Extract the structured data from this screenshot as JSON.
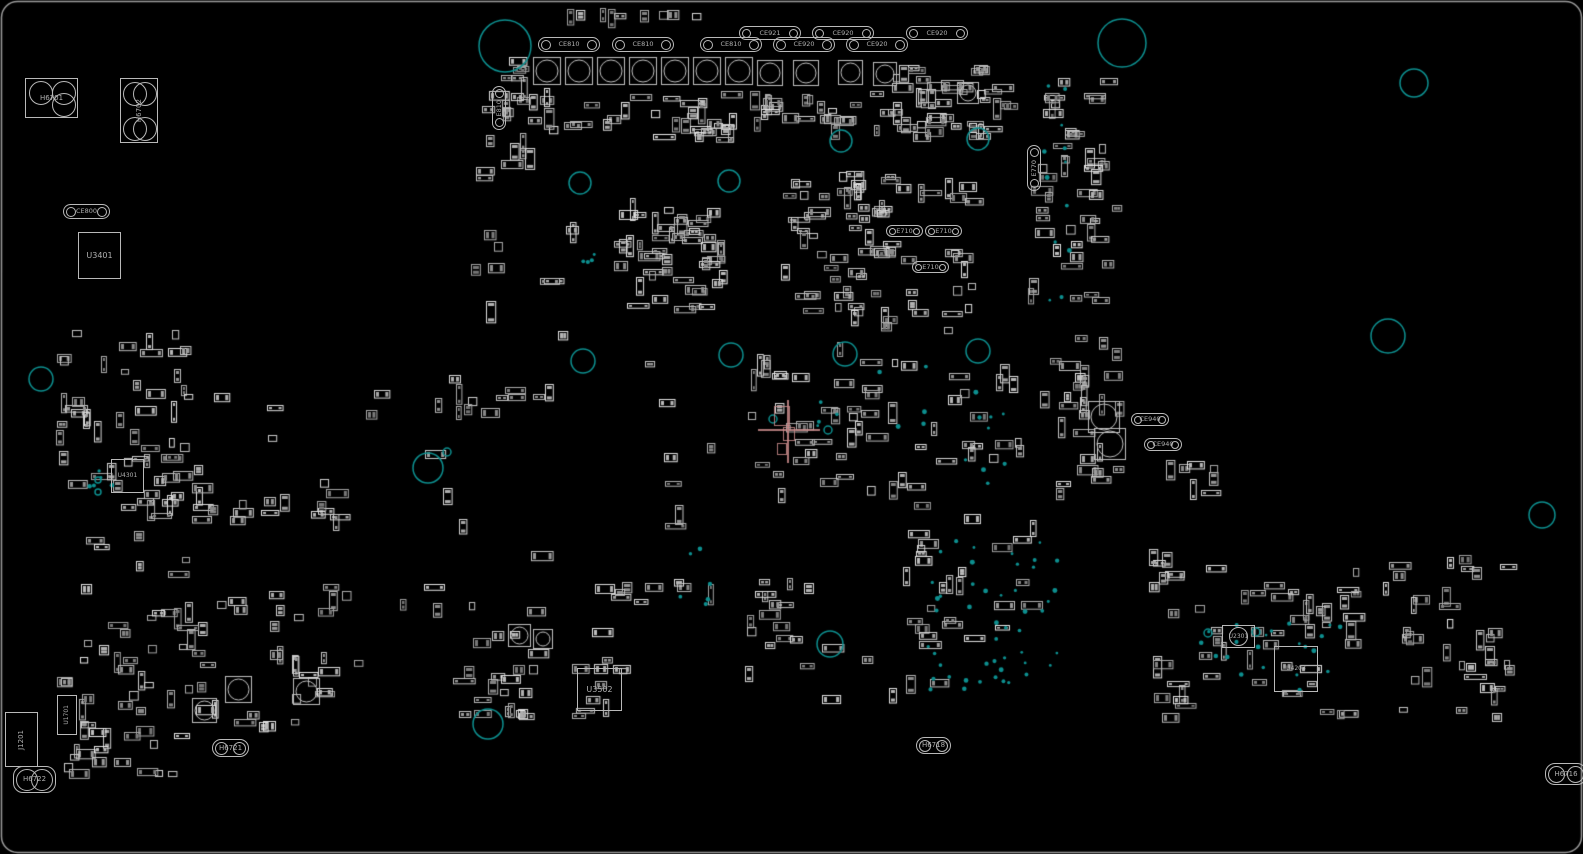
{
  "board": {
    "title": "pcb-component-placement-view",
    "colors": {
      "background": "#000000",
      "silkscreen": "#b4b4b4",
      "pad_fill": "#878787",
      "board_edge": "#9a9a9a",
      "teal": "#0d8f8f",
      "cursor": "#c98b8b"
    },
    "cursor": {
      "x": 788,
      "y": 430
    },
    "components": [
      {
        "type": "bracket",
        "label": "H6701",
        "x": 25,
        "y": 78,
        "w": 53,
        "h": 40,
        "circles": [
          {
            "dx": 3,
            "dy": 2,
            "d": 24
          },
          {
            "dx": 26,
            "dy": 2,
            "d": 24
          },
          {
            "dx": 26,
            "dy": 14,
            "d": 24
          }
        ]
      },
      {
        "type": "bracket",
        "label": "H6702",
        "x": 120,
        "y": 78,
        "w": 38,
        "h": 65,
        "vertical": true,
        "circles": [
          {
            "dx": 2,
            "dy": 3,
            "d": 24
          },
          {
            "dx": 12,
            "dy": 3,
            "d": 24
          },
          {
            "dx": 2,
            "dy": 38,
            "d": 24
          },
          {
            "dx": 12,
            "dy": 38,
            "d": 24
          }
        ]
      },
      {
        "type": "cap",
        "label": "CE800",
        "x": 63,
        "y": 204,
        "w": 47,
        "h": 15
      },
      {
        "type": "ic",
        "label": "U3401",
        "x": 78,
        "y": 232,
        "w": 43,
        "h": 47
      },
      {
        "type": "cap",
        "label": "CE810",
        "x": 538,
        "y": 37,
        "w": 62,
        "h": 15
      },
      {
        "type": "cap",
        "label": "CE810",
        "x": 612,
        "y": 37,
        "w": 62,
        "h": 15
      },
      {
        "type": "cap",
        "label": "CE810",
        "x": 700,
        "y": 37,
        "w": 62,
        "h": 15
      },
      {
        "type": "cap",
        "label": "CE920",
        "x": 773,
        "y": 37,
        "w": 62,
        "h": 15
      },
      {
        "type": "cap",
        "label": "CE920",
        "x": 846,
        "y": 37,
        "w": 62,
        "h": 15
      },
      {
        "type": "cap",
        "label": "CE921",
        "x": 739,
        "y": 26,
        "w": 62,
        "h": 14
      },
      {
        "type": "cap",
        "label": "CE920",
        "x": 812,
        "y": 26,
        "w": 62,
        "h": 14
      },
      {
        "type": "cap",
        "label": "CE920",
        "x": 906,
        "y": 26,
        "w": 62,
        "h": 14
      },
      {
        "type": "cap",
        "label": "E810",
        "x": 492,
        "y": 86,
        "w": 14,
        "h": 44,
        "vertical": true
      },
      {
        "type": "cap",
        "label": "E770",
        "x": 1027,
        "y": 145,
        "w": 14,
        "h": 46,
        "vertical": true
      },
      {
        "type": "cap",
        "label": "E710",
        "x": 886,
        "y": 225,
        "w": 37,
        "h": 12
      },
      {
        "type": "cap",
        "label": "E710",
        "x": 925,
        "y": 225,
        "w": 37,
        "h": 12
      },
      {
        "type": "cap",
        "label": "E710",
        "x": 912,
        "y": 261,
        "w": 37,
        "h": 12
      },
      {
        "type": "cap",
        "label": "CE940",
        "x": 1131,
        "y": 413,
        "w": 38,
        "h": 13
      },
      {
        "type": "cap",
        "label": "CE940",
        "x": 1144,
        "y": 438,
        "w": 38,
        "h": 13
      },
      {
        "type": "ic",
        "label": "U4301",
        "x": 111,
        "y": 459,
        "w": 33,
        "h": 34,
        "small": true
      },
      {
        "type": "ic",
        "label": "U3502",
        "x": 577,
        "y": 668,
        "w": 45,
        "h": 43
      },
      {
        "type": "roundcap",
        "label": "U2301",
        "x": 1222,
        "y": 625,
        "w": 33,
        "h": 23
      },
      {
        "type": "ic",
        "label": "U4203",
        "x": 1274,
        "y": 646,
        "w": 44,
        "h": 46,
        "small": true
      },
      {
        "type": "conn",
        "label": "J1201",
        "x": 5,
        "y": 712,
        "w": 33,
        "h": 55,
        "vertical": true
      },
      {
        "type": "ic",
        "label": "U1701",
        "x": 57,
        "y": 695,
        "w": 20,
        "h": 40,
        "vertical": true,
        "small": true
      },
      {
        "type": "hole",
        "label": "H6721",
        "x": 212,
        "y": 739,
        "w": 37,
        "h": 18
      },
      {
        "type": "hole",
        "label": "H6718",
        "x": 916,
        "y": 737,
        "w": 35,
        "h": 17
      },
      {
        "type": "hole",
        "label": "H6722",
        "x": 13,
        "y": 766,
        "w": 43,
        "h": 27
      },
      {
        "type": "hole",
        "label": "H6716",
        "x": 1545,
        "y": 763,
        "w": 42,
        "h": 22
      }
    ],
    "teal_circles": [
      {
        "x": 505,
        "y": 46,
        "r": 26
      },
      {
        "x": 1122,
        "y": 43,
        "r": 24
      },
      {
        "x": 1414,
        "y": 83,
        "r": 14
      },
      {
        "x": 841,
        "y": 141,
        "r": 11
      },
      {
        "x": 978,
        "y": 139,
        "r": 11
      },
      {
        "x": 580,
        "y": 183,
        "r": 11
      },
      {
        "x": 729,
        "y": 181,
        "r": 11
      },
      {
        "x": 583,
        "y": 361,
        "r": 12
      },
      {
        "x": 731,
        "y": 355,
        "r": 12
      },
      {
        "x": 845,
        "y": 354,
        "r": 12
      },
      {
        "x": 978,
        "y": 351,
        "r": 12
      },
      {
        "x": 1388,
        "y": 336,
        "r": 17
      },
      {
        "x": 41,
        "y": 379,
        "r": 12
      },
      {
        "x": 428,
        "y": 468,
        "r": 15
      },
      {
        "x": 447,
        "y": 452,
        "r": 4
      },
      {
        "x": 1542,
        "y": 515,
        "r": 13
      },
      {
        "x": 830,
        "y": 644,
        "r": 13
      },
      {
        "x": 488,
        "y": 724,
        "r": 15
      },
      {
        "x": 773,
        "y": 419,
        "r": 4
      },
      {
        "x": 828,
        "y": 430,
        "r": 4
      },
      {
        "x": 1208,
        "y": 633,
        "r": 4
      },
      {
        "x": 1256,
        "y": 632,
        "r": 4
      },
      {
        "x": 98,
        "y": 480,
        "r": 3
      },
      {
        "x": 98,
        "y": 492,
        "r": 3
      }
    ],
    "big_caps": [
      {
        "x": 533,
        "y": 57,
        "s": 27
      },
      {
        "x": 565,
        "y": 57,
        "s": 27
      },
      {
        "x": 597,
        "y": 57,
        "s": 27
      },
      {
        "x": 629,
        "y": 57,
        "s": 27
      },
      {
        "x": 661,
        "y": 57,
        "s": 27
      },
      {
        "x": 693,
        "y": 57,
        "s": 27
      },
      {
        "x": 725,
        "y": 57,
        "s": 27
      },
      {
        "x": 757,
        "y": 60,
        "s": 25
      },
      {
        "x": 793,
        "y": 60,
        "s": 25
      },
      {
        "x": 838,
        "y": 60,
        "s": 24
      },
      {
        "x": 873,
        "y": 62,
        "s": 23
      },
      {
        "x": 957,
        "y": 82,
        "s": 21
      },
      {
        "x": 1088,
        "y": 401,
        "s": 31
      },
      {
        "x": 1094,
        "y": 428,
        "s": 31
      },
      {
        "x": 225,
        "y": 676,
        "s": 26
      },
      {
        "x": 293,
        "y": 678,
        "s": 26
      },
      {
        "x": 192,
        "y": 698,
        "s": 24
      },
      {
        "x": 508,
        "y": 624,
        "s": 22
      },
      {
        "x": 533,
        "y": 629,
        "s": 19
      }
    ],
    "clusters": [
      {
        "x": 480,
        "y": 88,
        "w": 390,
        "h": 55,
        "n": 60,
        "seed": 11
      },
      {
        "x": 500,
        "y": 55,
        "w": 30,
        "h": 80,
        "n": 8,
        "seed": 12
      },
      {
        "x": 560,
        "y": 10,
        "w": 160,
        "h": 12,
        "n": 9,
        "seed": 13
      },
      {
        "x": 868,
        "y": 62,
        "w": 150,
        "h": 80,
        "n": 46,
        "seed": 14
      },
      {
        "x": 1028,
        "y": 78,
        "w": 95,
        "h": 235,
        "n": 46,
        "seed": 15
      },
      {
        "x": 612,
        "y": 198,
        "w": 120,
        "h": 115,
        "n": 48,
        "seed": 16
      },
      {
        "x": 780,
        "y": 168,
        "w": 100,
        "h": 160,
        "n": 34,
        "seed": 17
      },
      {
        "x": 848,
        "y": 170,
        "w": 135,
        "h": 55,
        "n": 18,
        "seed": 18
      },
      {
        "x": 848,
        "y": 240,
        "w": 135,
        "h": 95,
        "n": 26,
        "seed": 19
      },
      {
        "x": 1040,
        "y": 330,
        "w": 85,
        "h": 175,
        "n": 28,
        "seed": 20
      },
      {
        "x": 755,
        "y": 340,
        "w": 270,
        "h": 185,
        "n": 58,
        "seed": 21
      },
      {
        "x": 55,
        "y": 330,
        "w": 150,
        "h": 235,
        "n": 52,
        "seed": 22
      },
      {
        "x": 55,
        "y": 560,
        "w": 310,
        "h": 175,
        "n": 62,
        "seed": 23
      },
      {
        "x": 448,
        "y": 618,
        "w": 200,
        "h": 105,
        "n": 32,
        "seed": 24
      },
      {
        "x": 1150,
        "y": 550,
        "w": 370,
        "h": 175,
        "n": 85,
        "seed": 25
      },
      {
        "x": 230,
        "y": 478,
        "w": 135,
        "h": 55,
        "n": 13,
        "seed": 26
      },
      {
        "x": 435,
        "y": 380,
        "w": 130,
        "h": 45,
        "n": 11,
        "seed": 27
      },
      {
        "x": 575,
        "y": 578,
        "w": 150,
        "h": 28,
        "n": 9,
        "seed": 28
      },
      {
        "x": 745,
        "y": 555,
        "w": 75,
        "h": 105,
        "n": 13,
        "seed": 29
      },
      {
        "x": 895,
        "y": 520,
        "w": 150,
        "h": 130,
        "n": 24,
        "seed": 30
      },
      {
        "x": 160,
        "y": 440,
        "w": 60,
        "h": 90,
        "n": 11,
        "seed": 31
      },
      {
        "x": 1165,
        "y": 455,
        "w": 60,
        "h": 45,
        "n": 7,
        "seed": 32
      },
      {
        "x": 210,
        "y": 330,
        "w": 260,
        "h": 150,
        "n": 7,
        "seed": 33
      },
      {
        "x": 380,
        "y": 470,
        "w": 180,
        "h": 150,
        "n": 8,
        "seed": 34
      },
      {
        "x": 640,
        "y": 340,
        "w": 130,
        "h": 190,
        "n": 9,
        "seed": 35
      },
      {
        "x": 470,
        "y": 180,
        "w": 110,
        "h": 170,
        "n": 10,
        "seed": 36
      },
      {
        "x": 1125,
        "y": 540,
        "w": 60,
        "h": 80,
        "n": 5,
        "seed": 37
      },
      {
        "x": 730,
        "y": 625,
        "w": 230,
        "h": 80,
        "n": 10,
        "seed": 38
      },
      {
        "x": 60,
        "y": 690,
        "w": 130,
        "h": 95,
        "n": 22,
        "seed": 39
      },
      {
        "x": 475,
        "y": 130,
        "w": 60,
        "h": 55,
        "n": 8,
        "seed": 40
      }
    ],
    "via_fields": [
      {
        "x": 920,
        "y": 540,
        "w": 140,
        "h": 160,
        "n": 40,
        "seed": 51
      },
      {
        "x": 1042,
        "y": 85,
        "w": 30,
        "h": 220,
        "n": 12,
        "seed": 52
      },
      {
        "x": 810,
        "y": 360,
        "w": 120,
        "h": 80,
        "n": 9,
        "seed": 53
      },
      {
        "x": 950,
        "y": 380,
        "w": 60,
        "h": 120,
        "n": 9,
        "seed": 54
      },
      {
        "x": 1255,
        "y": 620,
        "w": 100,
        "h": 80,
        "n": 14,
        "seed": 55
      },
      {
        "x": 85,
        "y": 470,
        "w": 30,
        "h": 35,
        "n": 5,
        "seed": 56
      },
      {
        "x": 578,
        "y": 250,
        "w": 22,
        "h": 22,
        "n": 4,
        "seed": 57
      },
      {
        "x": 680,
        "y": 545,
        "w": 60,
        "h": 60,
        "n": 6,
        "seed": 58
      },
      {
        "x": 985,
        "y": 655,
        "w": 60,
        "h": 45,
        "n": 8,
        "seed": 59
      },
      {
        "x": 1190,
        "y": 620,
        "w": 60,
        "h": 60,
        "n": 7,
        "seed": 60
      }
    ]
  }
}
